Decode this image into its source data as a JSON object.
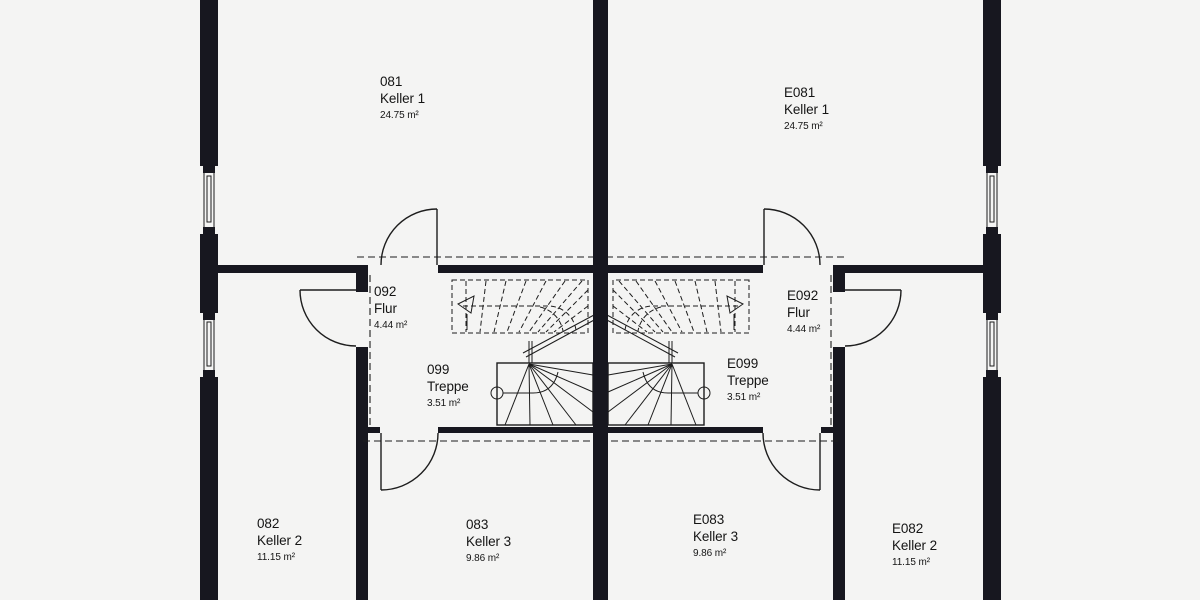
{
  "colors": {
    "background": "#f4f4f3",
    "wall": "#17171f",
    "line": "#1d1d1d"
  },
  "rooms": [
    {
      "id": "081",
      "name": "Keller 1",
      "area": "24.75 m²"
    },
    {
      "id": "E081",
      "name": "Keller 1",
      "area": "24.75 m²"
    },
    {
      "id": "092",
      "name": "Flur",
      "area": "4.44 m²"
    },
    {
      "id": "E092",
      "name": "Flur",
      "area": "4.44 m²"
    },
    {
      "id": "099",
      "name": "Treppe",
      "area": "3.51 m²"
    },
    {
      "id": "E099",
      "name": "Treppe",
      "area": "3.51 m²"
    },
    {
      "id": "082",
      "name": "Keller 2",
      "area": "11.15 m²"
    },
    {
      "id": "083",
      "name": "Keller 3",
      "area": "9.86 m²"
    },
    {
      "id": "E083",
      "name": "Keller 3",
      "area": "9.86 m²"
    },
    {
      "id": "E082",
      "name": "Keller 2",
      "area": "11.15 m²"
    }
  ]
}
